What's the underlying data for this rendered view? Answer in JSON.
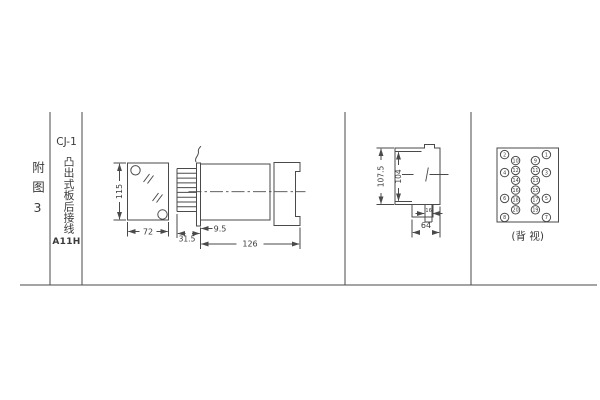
{
  "colors": {
    "line": "#4a4a4a",
    "text": "#3a3a3a",
    "background": "#ffffff"
  },
  "title_block": {
    "figure_label": "附图3",
    "model": "CJ-1",
    "mounting": "凸出式板后接线",
    "code": "A11H"
  },
  "views": {
    "front": {
      "dims": {
        "height": "115",
        "width": "72"
      }
    },
    "side": {
      "dims": {
        "pin_length": "31.5",
        "panel_offset": "9.5",
        "total_length": "126"
      }
    },
    "rear": {
      "dims": {
        "outer_height": "107.5",
        "inner_height": "104",
        "notch_width": "16",
        "width": "64"
      }
    },
    "back": {
      "caption": "(背 视)",
      "terminals": {
        "outer_left": [
          "2",
          "4",
          "6",
          "8"
        ],
        "inner_left": [
          "10",
          "12",
          "14",
          "16",
          "18",
          "20"
        ],
        "inner_right": [
          "9",
          "11",
          "13",
          "15",
          "17",
          "19"
        ],
        "outer_right": [
          "1",
          "3",
          "5",
          "7"
        ]
      }
    }
  }
}
